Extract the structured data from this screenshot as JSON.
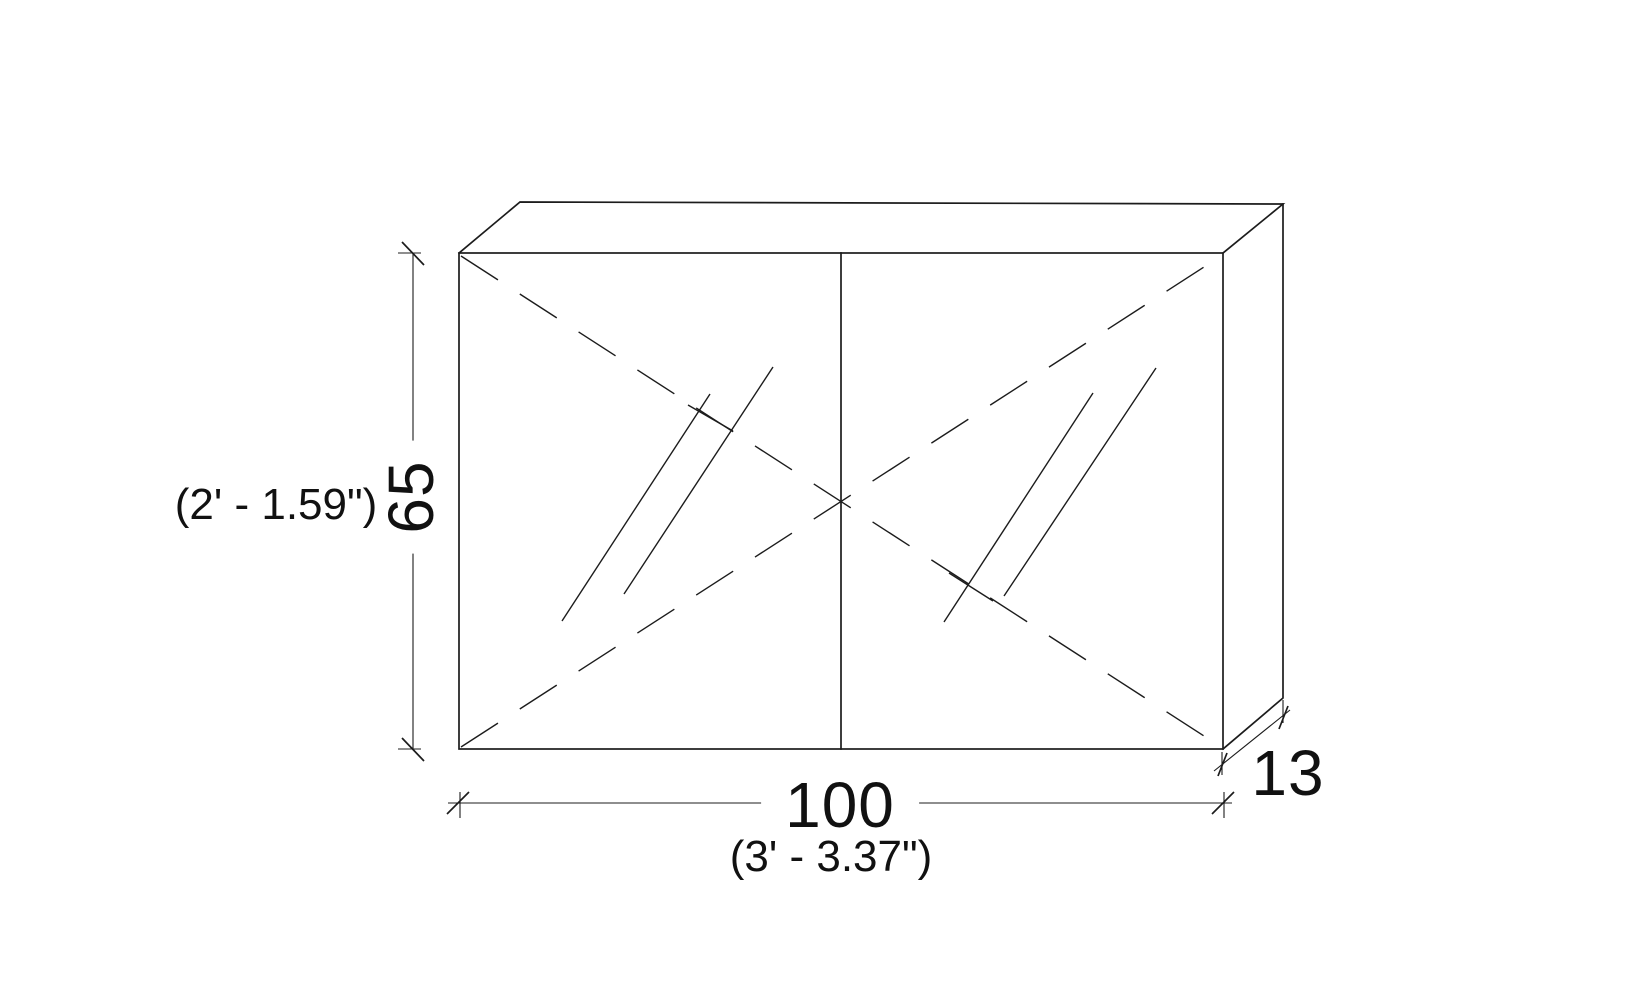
{
  "drawing": {
    "kind": "cabinet-elevation",
    "colors": {
      "line": "#1c1c1c",
      "background": "#ffffff",
      "text": "#111111"
    },
    "dimensions": {
      "height": {
        "value": "65",
        "imperial_label": "(2' - 1.59\")"
      },
      "width": {
        "value": "100",
        "imperial_label": "(3' - 3.37\")"
      },
      "depth": {
        "value": "13"
      }
    }
  }
}
